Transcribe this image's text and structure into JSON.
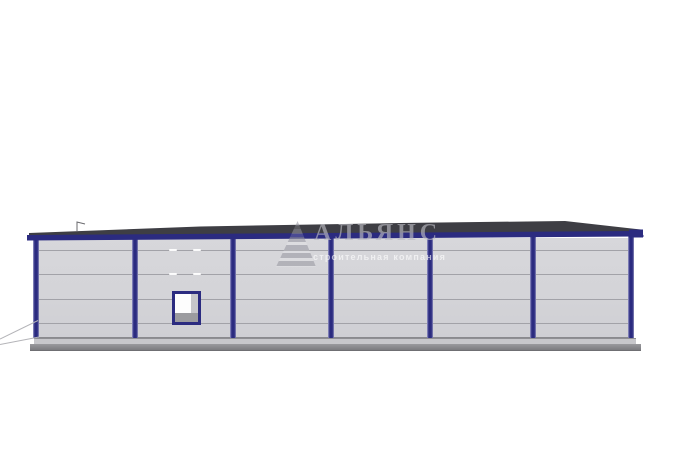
{
  "watermark": {
    "logo_icon": "striped-pyramid-logo",
    "title": "АЛЬЯНС",
    "subtitle": "строительная компания"
  },
  "colors": {
    "background": "#ffffff",
    "frame_navy": "#2b2b80",
    "roof_dark": "#3e3e44",
    "panel_gray": "#d4d4d8",
    "seam_gray": "#a2a2a8",
    "window_sill_gray": "#9b9b9f",
    "foundation_gray": "#8b8b8f",
    "ground_line_gray": "#b4b4b8"
  }
}
